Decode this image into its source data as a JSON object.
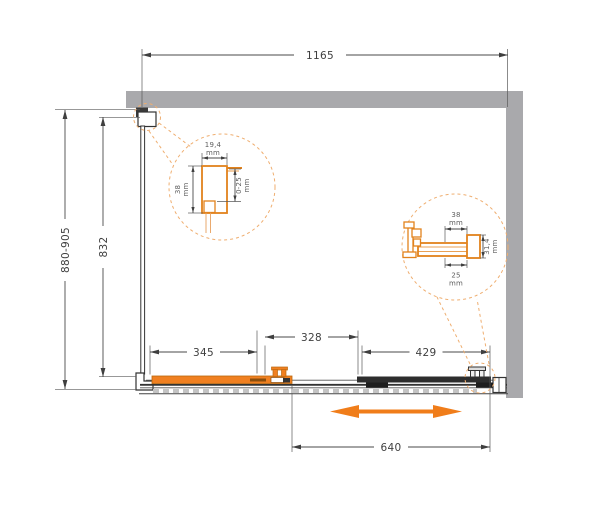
{
  "drawing": {
    "unit": "mm",
    "overall": {
      "width_total": "1165",
      "height_range": "880-905",
      "glass_height": "832"
    },
    "segments": {
      "left": "345",
      "middle": "328",
      "right": "429",
      "opening": "640"
    },
    "detail_left": {
      "profile_width": "19,4",
      "profile_depth": "38",
      "adjustment_range": "0-25"
    },
    "detail_right": {
      "bracket_width": "38",
      "bracket_height": "31,4",
      "bracket_depth": "25"
    },
    "colors": {
      "accent": "#F07D1A",
      "wall": "#A9A9AC",
      "line": "#3E3E3E"
    }
  }
}
